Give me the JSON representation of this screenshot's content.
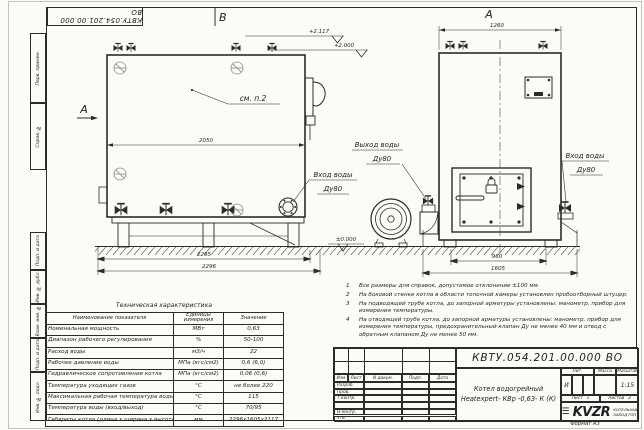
{
  "sheet": {
    "stamp_number": "КВТУ.054.201.00.000 ВО",
    "format_label": "Формат",
    "format_value": "А3"
  },
  "frame_labels": [
    "Перв. примен.",
    "Справ. №",
    "Подп. и дата",
    "Инв. № дубл.",
    "Взам. инв. №",
    "Подп. и дата",
    "Инв. № подл."
  ],
  "views": {
    "left": {
      "section_top": "В",
      "section_side": "А",
      "note_ref": "см. п.2",
      "dim_width": "2050",
      "dim_base": "2295",
      "dim_overall": "2296",
      "elev_top": "+2.117",
      "elev_mid": "+2.000",
      "elev_zero": "±0.000",
      "outlet_line1": "Выход воды",
      "outlet_line2": "Ду80",
      "inlet_line1": "Вход воды",
      "inlet_line2": "Ду80"
    },
    "right": {
      "view_label": "А",
      "dim_width": "1260",
      "dim_base": "960",
      "dim_overall": "1605",
      "inlet_line1": "Вход воды",
      "inlet_line2": "Ду80"
    }
  },
  "tech_table": {
    "title": "Техническая характеристика",
    "headers": [
      "Наименование показателя",
      "Единицы измерения",
      "Значение"
    ],
    "rows": [
      [
        "Номинальная мощность",
        "МВт",
        "0,63"
      ],
      [
        "Диапазон рабочего регулирования",
        "%",
        "50-100"
      ],
      [
        "Расход воды",
        "м3/ч",
        "22"
      ],
      [
        "Рабочее давление воды",
        "МПа (кгс/см2)",
        "0,6 (6,0)"
      ],
      [
        "Гидравлическое сопротивление котла",
        "МПа (кгс/см2)",
        "0,06 (0,6)"
      ],
      [
        "Температура уходящих газов",
        "°С",
        "не более 220"
      ],
      [
        "Максимальная рабочая температура воды",
        "°С",
        "115"
      ],
      [
        "Температура воды (вход/выход)",
        "°С",
        "70/95"
      ],
      [
        "Габариты котла (длина х ширина х высота)",
        "мм",
        "2296х1605х2117"
      ]
    ]
  },
  "notes": [
    {
      "num": "1",
      "text": "Все размеры для справок, допустимое отклонение ±100 мм."
    },
    {
      "num": "2",
      "text": "На боковой стенке котла в области топочной камеры установлен пробоотборный штуцер."
    },
    {
      "num": "3",
      "text": "На подводящей трубе котла, до запорной арматуры установлены: манометр, прибор для измерения температуры."
    },
    {
      "num": "4",
      "text": "На отводящей трубе котла, до запорной арматуры установлены: манометр, прибор для измерения температуры, предохранительный клапан Ду не менее 40 мм и отвод с обратным клапаном Ду не менее 50 мм."
    }
  ],
  "title_block": {
    "doc_number": "КВТУ.054.201.00.000  ВО",
    "product_name_line1": "Котел водогрейный",
    "product_name_line2": "Heatexpert- КВр -0,63- К (К)",
    "header_cols": [
      "Изм",
      "Лист",
      "N докум.",
      "Подп.",
      "Дата"
    ],
    "row_labels": [
      "Разраб.",
      "Пров.",
      "Т.контр.",
      "Н.контр.",
      "Утв."
    ],
    "lit_label": "Лит.",
    "lit_value": "И",
    "mass_label": "Масса",
    "scale_label": "Масштаб",
    "scale_value": "1:15",
    "sheet_label": "Лист",
    "sheet_value": "1",
    "sheets_label": "Листов",
    "sheets_value": "2",
    "logo_text": "KVZR",
    "company_line1": "КОТЕЛЬНЫЙ",
    "company_line2": "ЗАВОД РЭП"
  }
}
